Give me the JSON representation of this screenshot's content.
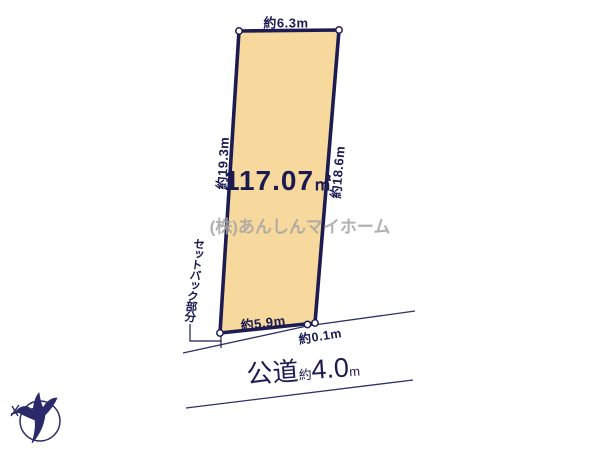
{
  "diagram": {
    "parcel": {
      "area_value": "117.07",
      "area_unit": "㎡",
      "top_width": "約6.3m",
      "left_length": "約19.3m",
      "right_length": "約18.6m",
      "bottom_width": "約5.9m",
      "offset": "約0.1m",
      "fill_color": "#f7d99e",
      "outline_color": "#1c1c52"
    },
    "setback_label": "セットバック部分",
    "road": {
      "name": "公道",
      "approx": "約",
      "width_value": "4.0",
      "unit": "m"
    },
    "watermark": "(株)あんしんマイホーム",
    "compass": {
      "icon": "north-arrow-bird"
    }
  }
}
